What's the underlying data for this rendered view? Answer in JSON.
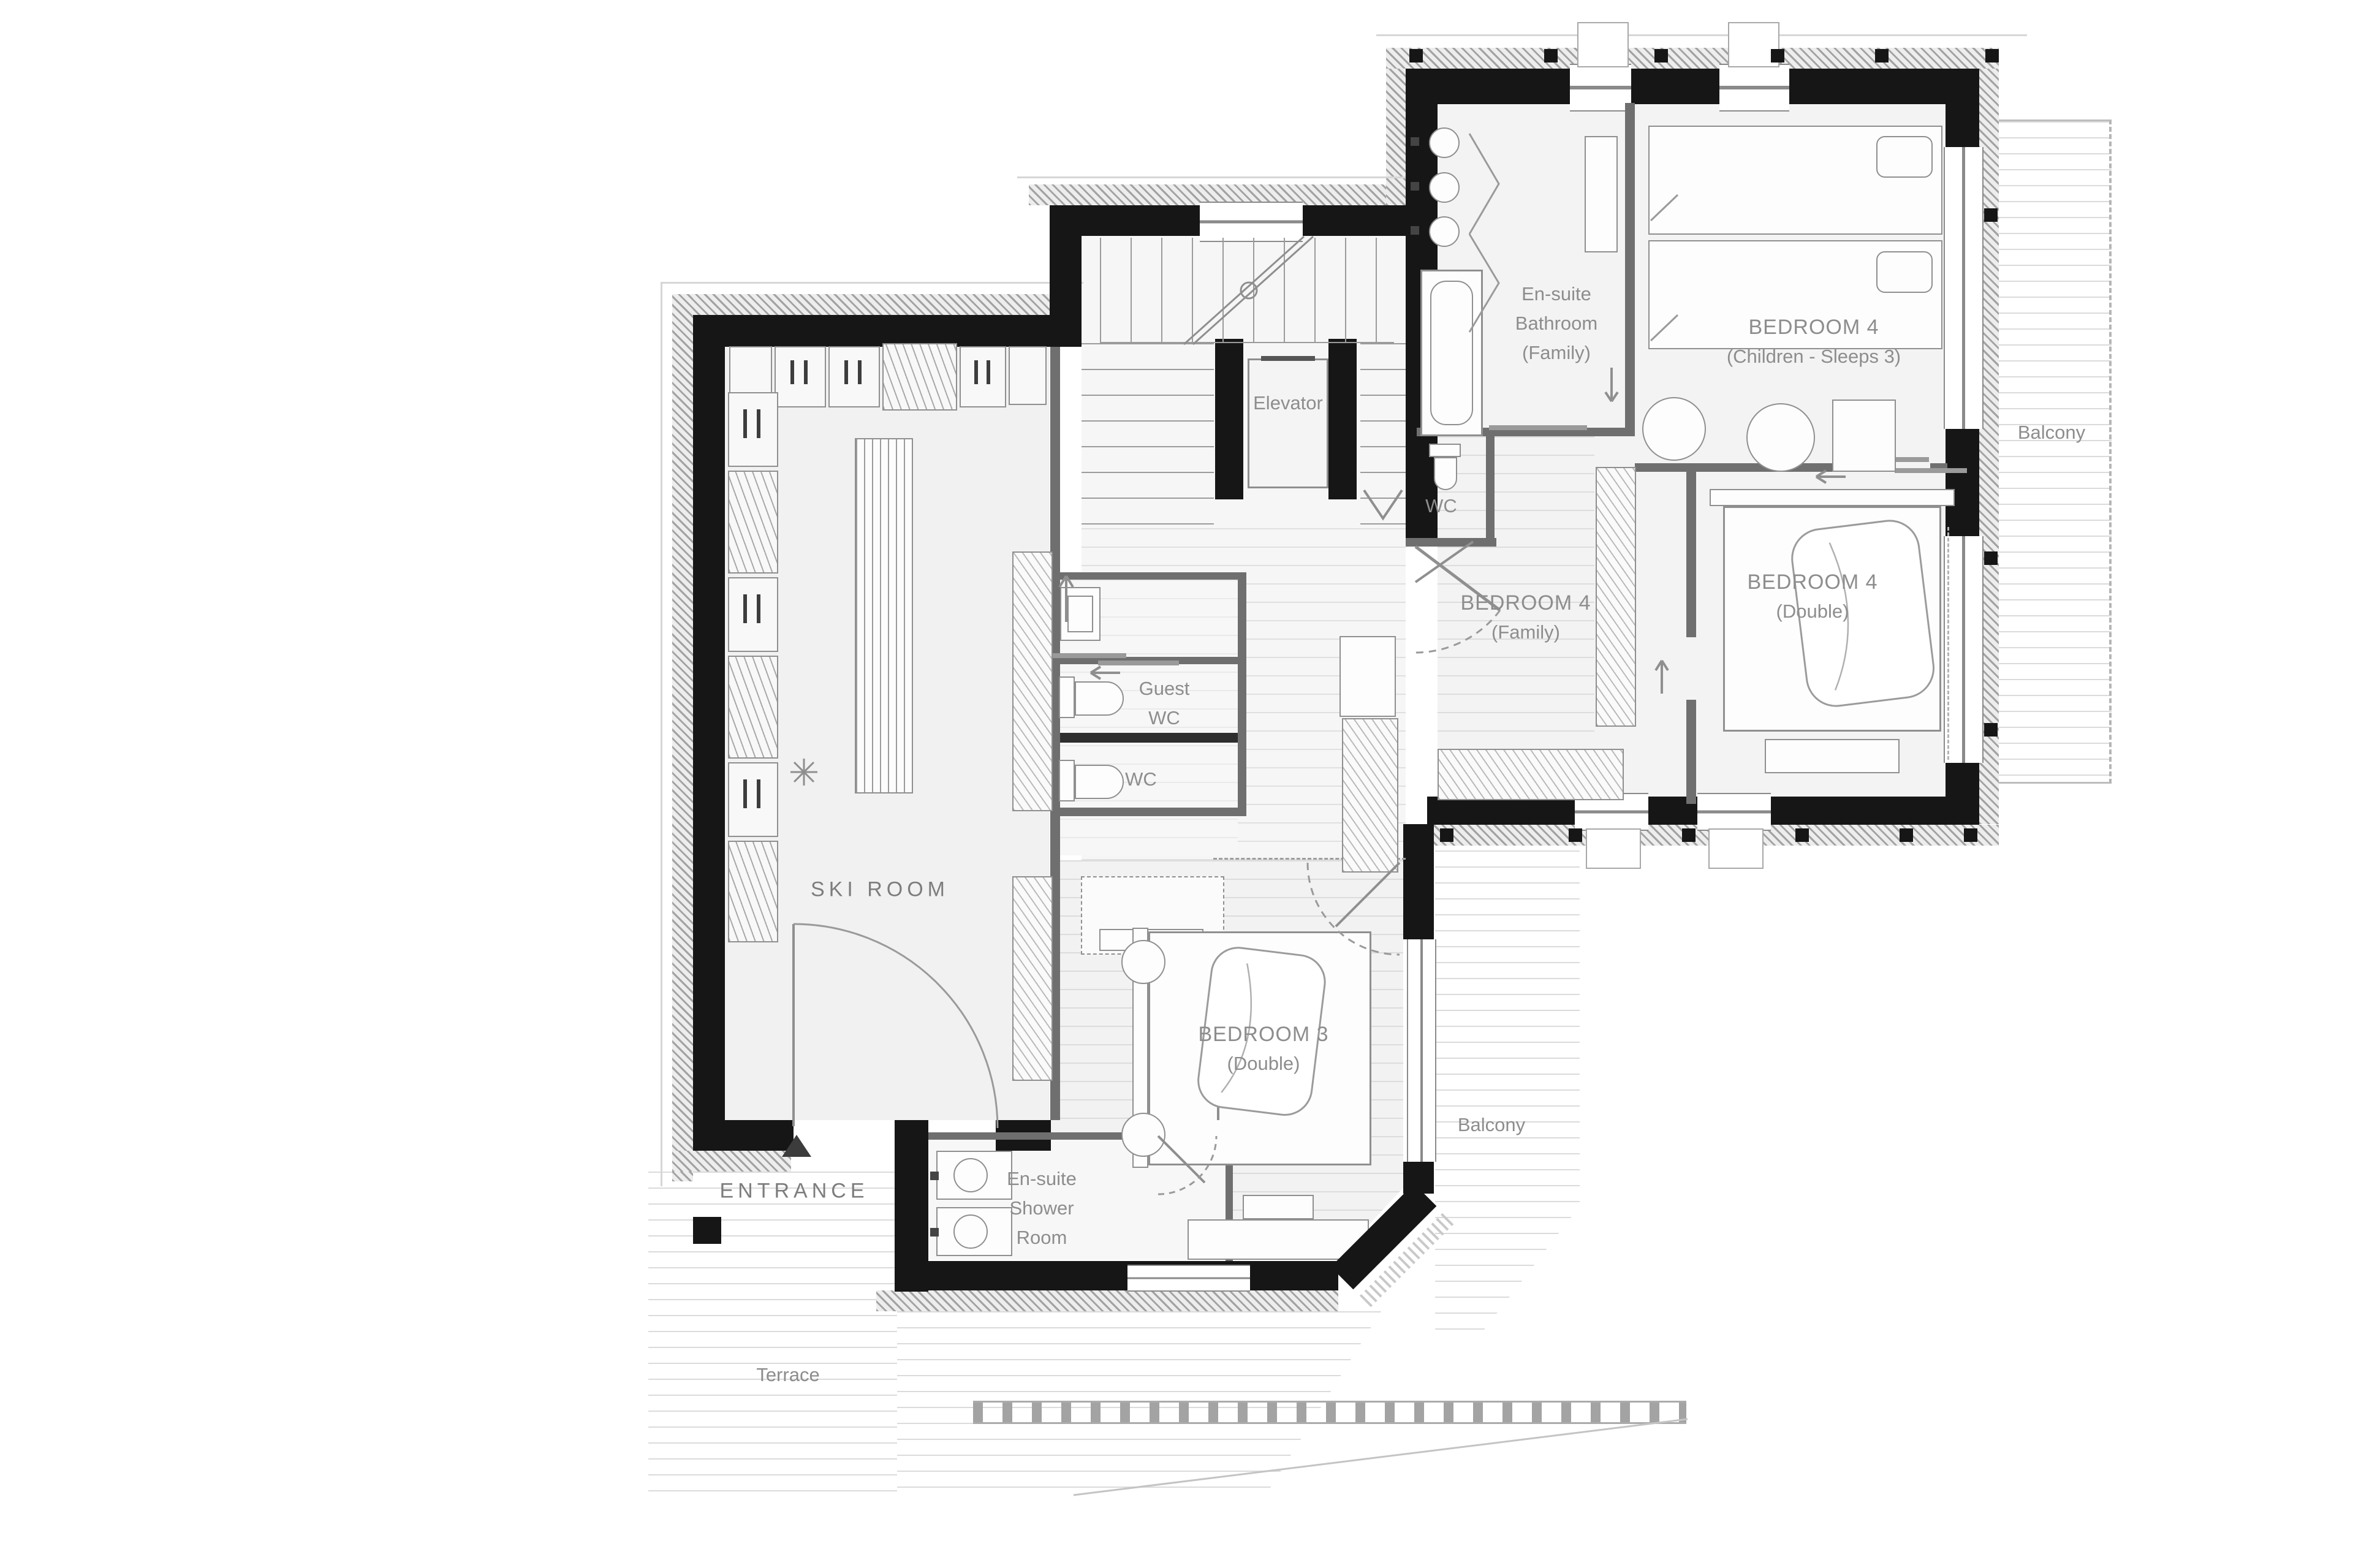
{
  "plan": {
    "rooms": {
      "elevator": {
        "name": "Elevator"
      },
      "ensuite_bathroom": {
        "l1": "En-suite",
        "l2": "Bathroom",
        "l3": "(Family)"
      },
      "bedroom4_children": {
        "l1": "BEDROOM 4",
        "l2": "(Children - Sleeps 3)"
      },
      "balcony_upper": {
        "name": "Balcony"
      },
      "wc_landing": {
        "name": "WC"
      },
      "bedroom4_family": {
        "l1": "BEDROOM 4",
        "l2": "(Family)"
      },
      "bedroom4_double": {
        "l1": "BEDROOM 4",
        "l2": "(Double)"
      },
      "guest_wc": {
        "l1": "Guest",
        "l2": "WC"
      },
      "wc_inner": {
        "name": "WC"
      },
      "ski_room": {
        "name": "SKI ROOM"
      },
      "bedroom3": {
        "l1": "BEDROOM 3",
        "l2": "(Double)"
      },
      "balcony_lower": {
        "name": "Balcony"
      },
      "entrance": {
        "name": "ENTRANCE"
      },
      "ensuite_shower": {
        "l1": "En-suite",
        "l2": "Shower",
        "l3": "Room"
      },
      "terrace": {
        "name": "Terrace"
      }
    },
    "colors": {
      "wall": "#161616",
      "label": "#8d8d8d",
      "deck_line": "#c9c9c9",
      "hatch": "#9c9c9c"
    }
  }
}
